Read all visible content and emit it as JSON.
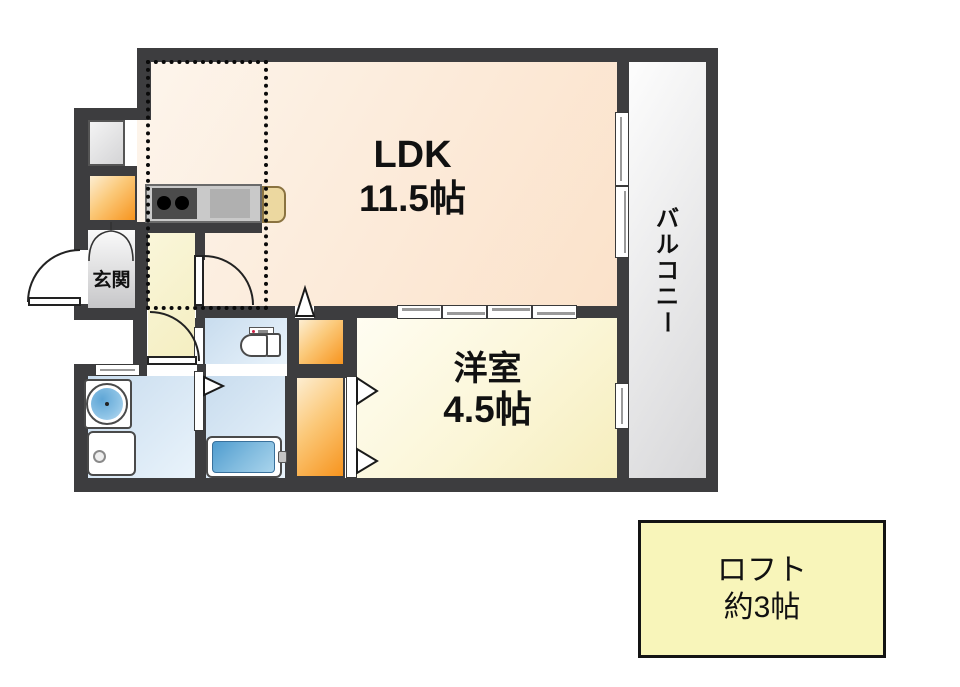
{
  "floorplan": {
    "rooms": {
      "ldk": {
        "name": "LDK",
        "size": "11.5帖"
      },
      "bedroom": {
        "name": "洋室",
        "size": "4.5帖"
      },
      "balcony": {
        "name": "バルコニー",
        "chars": [
          "バ",
          "ル",
          "コ",
          "ニ",
          "ー"
        ]
      },
      "entrance": {
        "name": "玄関"
      },
      "loft": {
        "name": "ロフト",
        "size": "約3帖"
      }
    },
    "colors": {
      "wall": "#3d3d3f",
      "ldk_floor": "#fbe2ca",
      "bedroom_floor": "#f6eebd",
      "hallway_floor": "#f4eec0",
      "wet_room_floor": "#cfe0ef",
      "closet_orange": "#f7941e",
      "balcony_gray": "#d7d7d9",
      "loft_bg": "#f8f5ba",
      "fridge_tan": "#ecd8a0"
    },
    "fixtures": [
      "kitchen-counter",
      "stove-burners",
      "kitchen-sink",
      "refrigerator",
      "toilet",
      "bathtub",
      "washbasin",
      "washing-machine"
    ]
  }
}
